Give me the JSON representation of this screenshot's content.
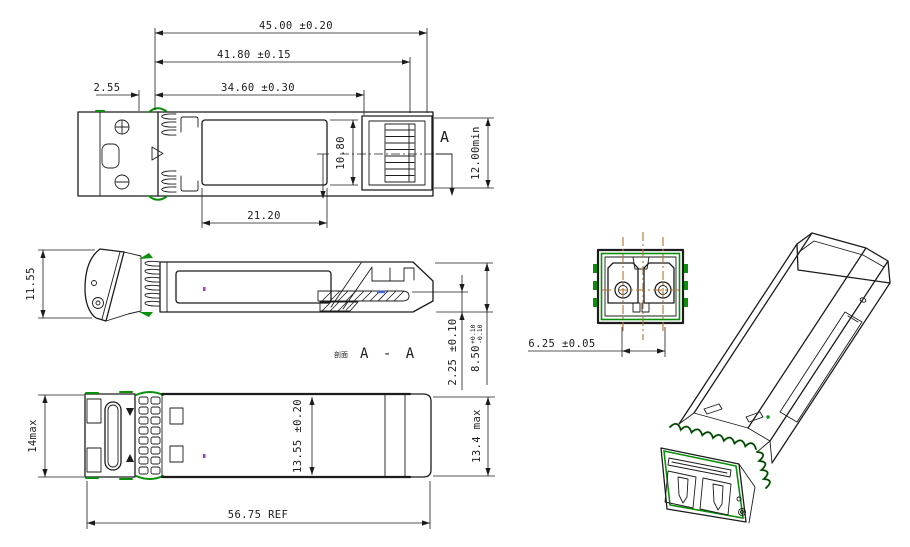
{
  "drawing": {
    "subject": "SFP optical transceiver outline drawing",
    "views": {
      "top": {
        "overall_length": "45.00 ±0.20",
        "latch_length": "41.80 ±0.15",
        "body_length": "34.60 ±0.30",
        "front_offset": "2.55",
        "label_length": "21.20",
        "label_width": "10.80",
        "height_min": "12.00min",
        "section_marker": "A"
      },
      "side": {
        "latch_height": "11.55",
        "pcb_offset": "2.25 ±0.10",
        "nose_height": "8.50",
        "nose_tol_plus": "+0.10",
        "nose_tol_minus": "-0.10",
        "section_prefix": "剖面",
        "section_name": "A - A"
      },
      "bottom": {
        "height_max": "14max",
        "body_width": "13.55 ±0.20",
        "width_max": "13.4 max",
        "overall_length_ref": "56.75 REF"
      },
      "front": {
        "port_pitch": "6.25 ±0.05"
      }
    },
    "colors": {
      "line": "#1c1c1c",
      "green": "#0a8f0a",
      "orange": "#b5722e",
      "blue": "#4466dd",
      "purple": "#a040c0",
      "bg": "#ffffff"
    }
  }
}
